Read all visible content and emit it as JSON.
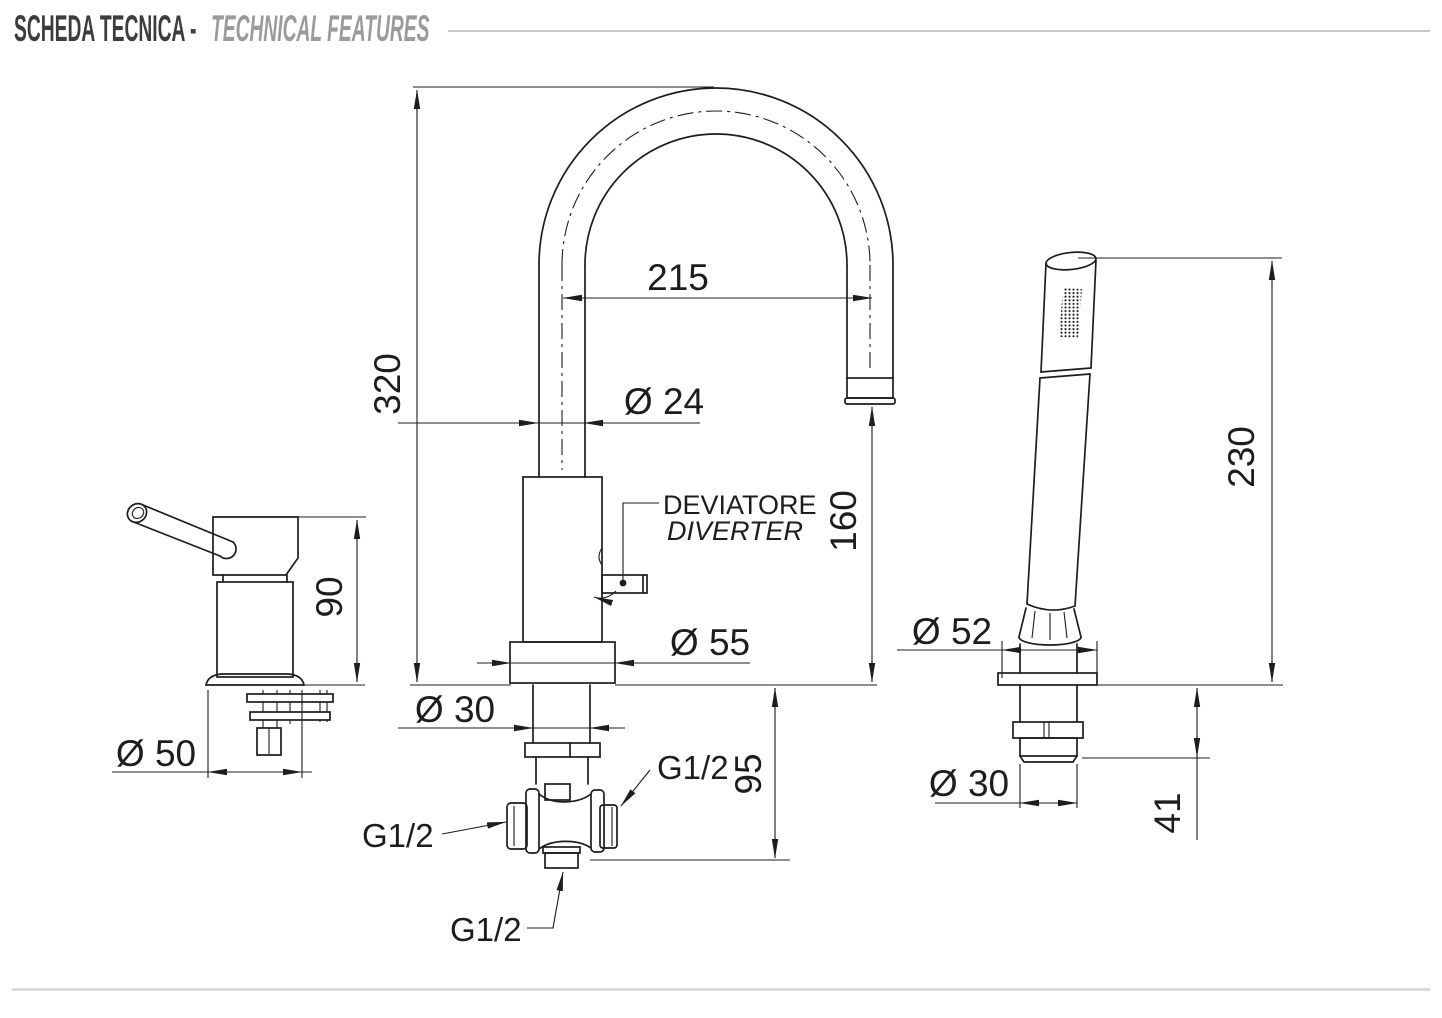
{
  "header": {
    "title_primary": "SCHEDA TECNICA -",
    "title_secondary": "TECHNICAL FEATURES"
  },
  "colors": {
    "line": "#1d1d1d",
    "title_primary": "#3d3d3d",
    "title_secondary": "#9b9b9b",
    "header_rule": "#c9c9c9",
    "footer_rule": "#dcdcdc",
    "background": "#ffffff"
  },
  "diagram": {
    "mixer_control": {
      "height": "90",
      "base_diameter": "Ø 50"
    },
    "spout": {
      "total_height": "320",
      "reach": "215",
      "tube_diameter": "Ø 24",
      "outlet_height": "160",
      "base_diameter": "Ø 55",
      "shank_diameter": "Ø 30",
      "under_deck_depth": "95",
      "diverter_label_it": "DEVIATORE",
      "diverter_label_en": "DIVERTER",
      "connection_left": "G1/2",
      "connection_right": "G1/2",
      "connection_bottom": "G1/2"
    },
    "handshower": {
      "height": "230",
      "escutcheon_diameter": "Ø 52",
      "shank_diameter": "Ø 30",
      "shank_length": "41"
    }
  }
}
